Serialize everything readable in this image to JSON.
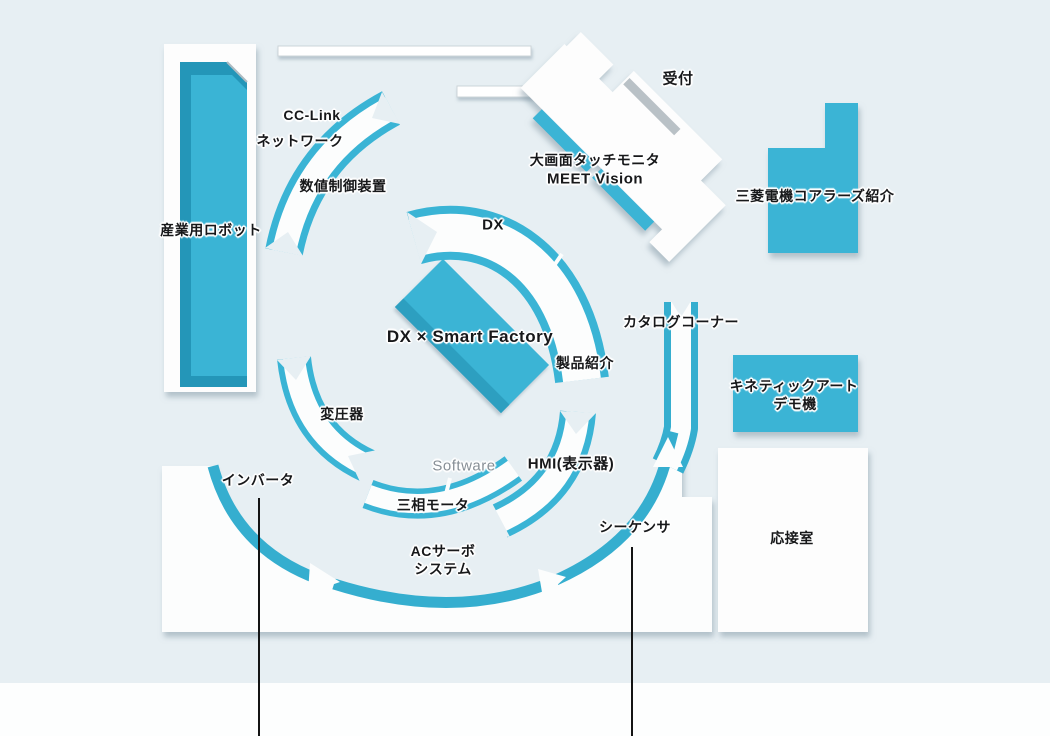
{
  "map_type": "showroom-floor-map",
  "colors": {
    "accent_teal": "#3ab4d5",
    "accent_teal_dark": "#2496b8",
    "ring_teal": "#35aecf",
    "background": "#e7eff3",
    "floor_white": "#fcfdfd",
    "slit_gray": "#b9c1c6",
    "label_text": "#17181a",
    "software_gray": "#878f96"
  },
  "areas": {
    "industrial_robot": {
      "label": "産業用ロボット"
    },
    "cc_link": {
      "label": "CC-Link"
    },
    "network": {
      "label": "ネットワーク"
    },
    "nc_device": {
      "label": "数値制御装置"
    },
    "reception": {
      "label": "受付"
    },
    "touch_monitor": {
      "label": "大画面タッチモニタ",
      "sublabel": "MEET Vision"
    },
    "koalas": {
      "label": "三菱電機コアラーズ紹介"
    },
    "dx": {
      "label": "DX"
    },
    "dx_smart_factory": {
      "label": "DX × Smart Factory"
    },
    "product_intro": {
      "label": "製品紹介"
    },
    "catalog_corner": {
      "label": "カタログコーナー"
    },
    "kinetic_art": {
      "label": "キネティックアート",
      "sublabel": "デモ機"
    },
    "transformer": {
      "label": "変圧器"
    },
    "inverter": {
      "label": "インバータ"
    },
    "software": {
      "label": "Software"
    },
    "hmi": {
      "label": "HMI(表示器)"
    },
    "three_phase_motor": {
      "label": "三相モータ"
    },
    "ac_servo": {
      "label": "ACサーボ",
      "sublabel": "システム"
    },
    "sequencer": {
      "label": "シーケンサ"
    },
    "drawing_room": {
      "label": "応接室"
    }
  }
}
